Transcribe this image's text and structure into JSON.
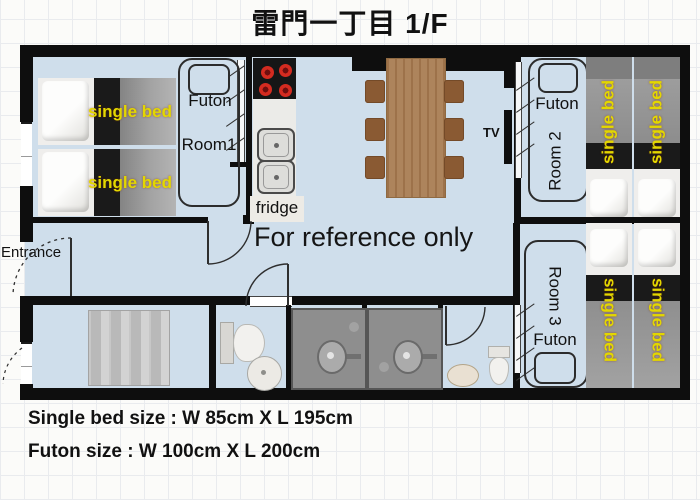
{
  "title": "雷門一丁目 1/F",
  "watermark": "For reference only",
  "entrance": "Entrance",
  "living": {
    "tv": "TV"
  },
  "kitchen": {
    "fridge": "fridge"
  },
  "room1": {
    "name": "Room1",
    "futon": "Futon",
    "bed1": "single bed",
    "bed2": "single bed"
  },
  "room2": {
    "name": "Room 2",
    "futon": "Futon",
    "bed1": "single bed",
    "bed2": "single bed"
  },
  "room3": {
    "name": "Room 3",
    "futon": "Futon",
    "bed1": "single bed",
    "bed2": "single bed"
  },
  "notes": {
    "single_bed": "Single bed size : W 85cm X L 195cm",
    "futon": "Futon size : W 100cm X L 200cm"
  },
  "colors": {
    "floor": "#cfdeeb",
    "wall": "#0e0e0e",
    "bed_label": "#e3d700",
    "table": "#a87c52",
    "burner": "#d42b20"
  }
}
